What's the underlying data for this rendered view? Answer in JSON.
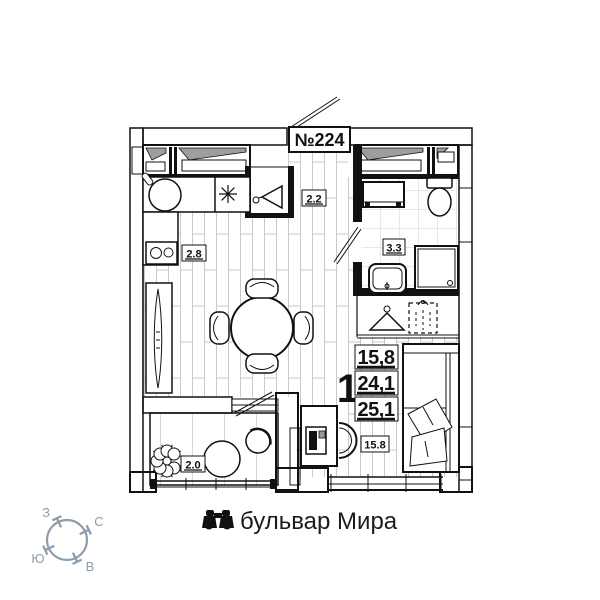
{
  "plan": {
    "apartment_number": "№224",
    "room_labels": {
      "hallway": "2.2",
      "kitchen": "2.8",
      "bathroom": "3.3",
      "balcony": "2.0",
      "room": "15.8"
    },
    "area_summary": {
      "rooms_count": "1",
      "living_area": "15,8",
      "apartment_area": "24,1",
      "total_area": "25,1"
    },
    "icons": {
      "closet": "coat-hanger-icon",
      "wardrobe": "coat-hanger-icon",
      "storage": "folded-clothes-icon"
    }
  },
  "compass": {
    "west": "З",
    "north": "С",
    "south": "Ю",
    "east": "В",
    "color": "#8d9cad",
    "icon": "compass-rose"
  },
  "footer": {
    "icon": "binoculars-icon",
    "street": "бульвар Мира"
  },
  "colors": {
    "line": "#111111",
    "exterior_wall_gray": "#c9c9c9",
    "window_sash_gray": "#9e9e9e",
    "floor_line_gray": "#c9c9c9",
    "background": "#ffffff"
  }
}
